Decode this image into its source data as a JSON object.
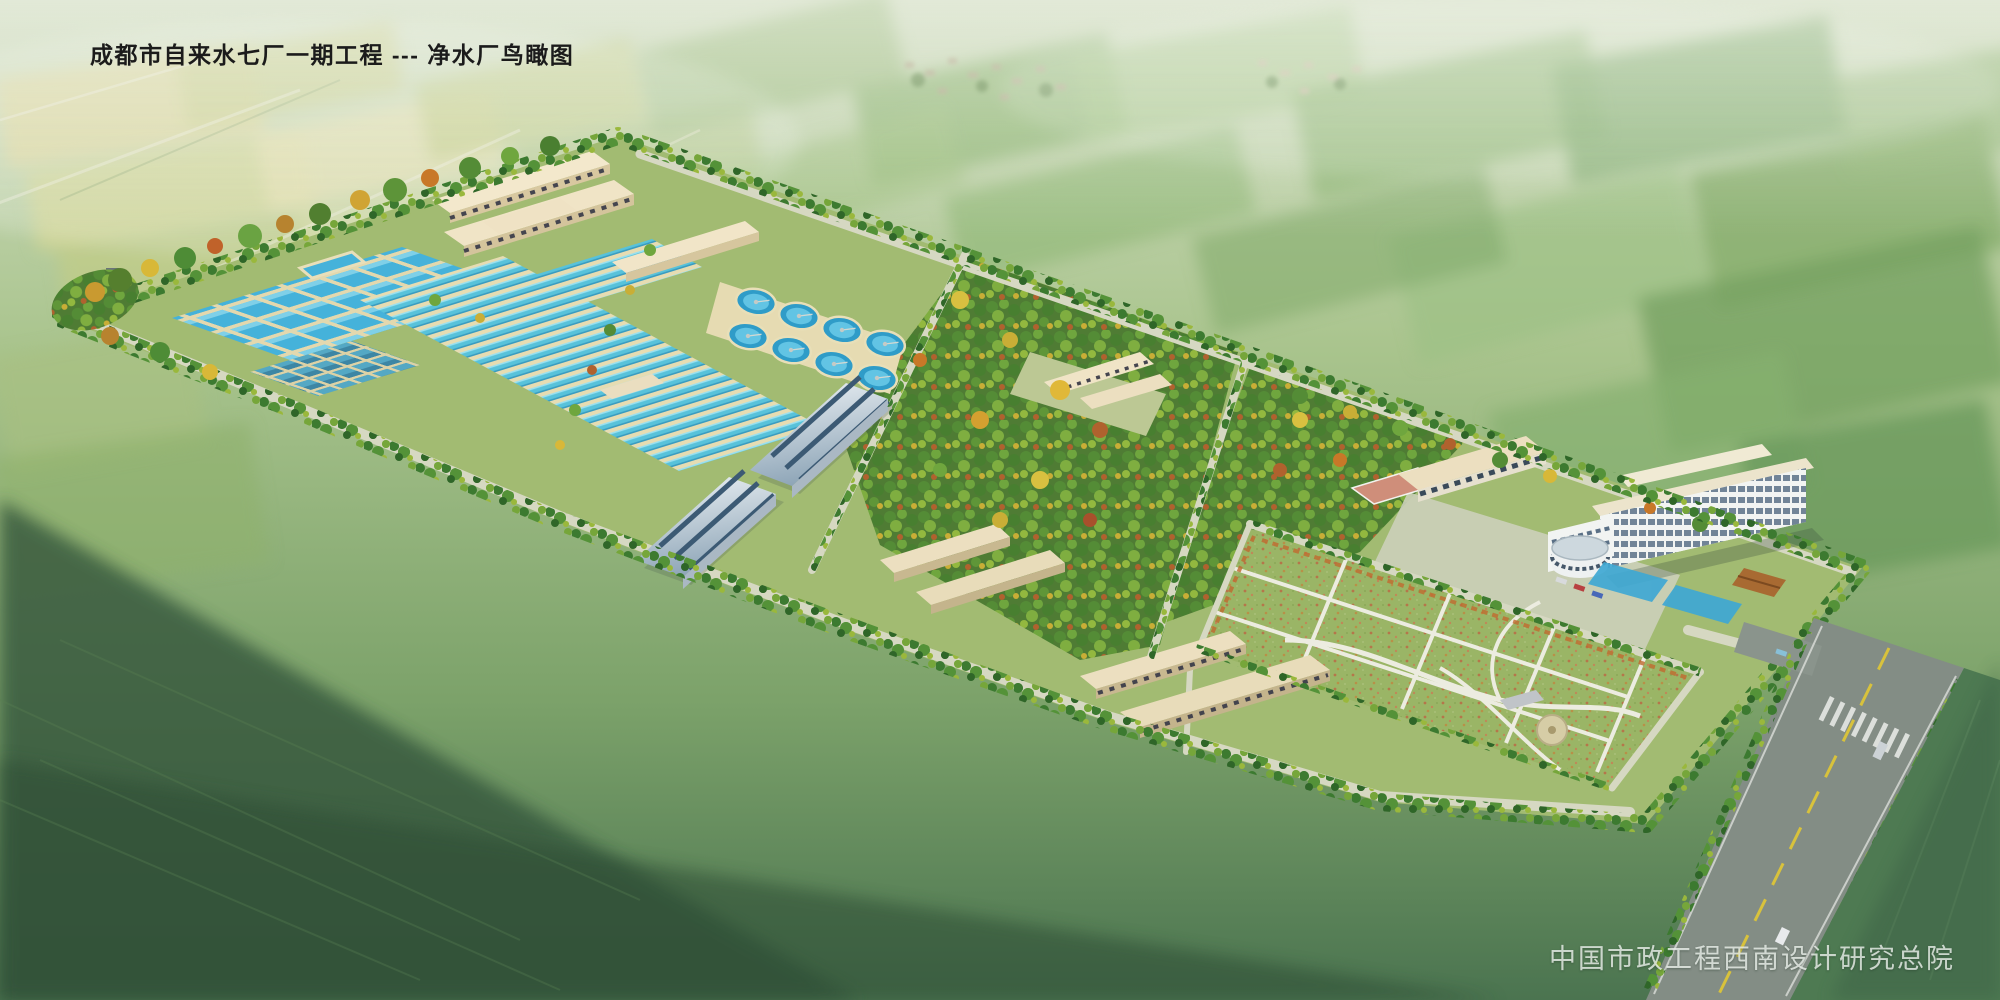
{
  "page": {
    "title_label": "成都市自来水七厂一期工程 --- 净水厂鸟瞰图",
    "credit_label": "中国市政工程西南设计研究总院"
  },
  "palette": {
    "sky_haze": "#dfe8d8",
    "field_green": "#8cb472",
    "field_yellow": "#d6d498",
    "site_ground": "#a2bb72",
    "water": "#45b2da",
    "lane_rim": "#e6dcb2",
    "roof_beige": "#f3e8cc",
    "roof_blue_gray": "#b9c8d4",
    "tree_green": "#548c36",
    "tree_autumn": "#c9ae36",
    "lawn": "#9ab566",
    "road": "#d6d8c2",
    "highway": "#838d85",
    "median_yellow": "#d8c23c"
  },
  "scene": {
    "features": [
      "farmland patchwork",
      "village clusters",
      "perimeter tree belt",
      "chemical dosing workshops",
      "clearwell pool",
      "flocculation basin grid",
      "filter cell grid",
      "sedimentation lanes",
      "circular clarifiers",
      "filter buildings",
      "tree groves",
      "workshop courtyard",
      "basketball court",
      "canteen building",
      "office building",
      "round exhibition hall",
      "landscape lawn",
      "dormitory rows",
      "service roads",
      "highway with crosswalk"
    ]
  }
}
